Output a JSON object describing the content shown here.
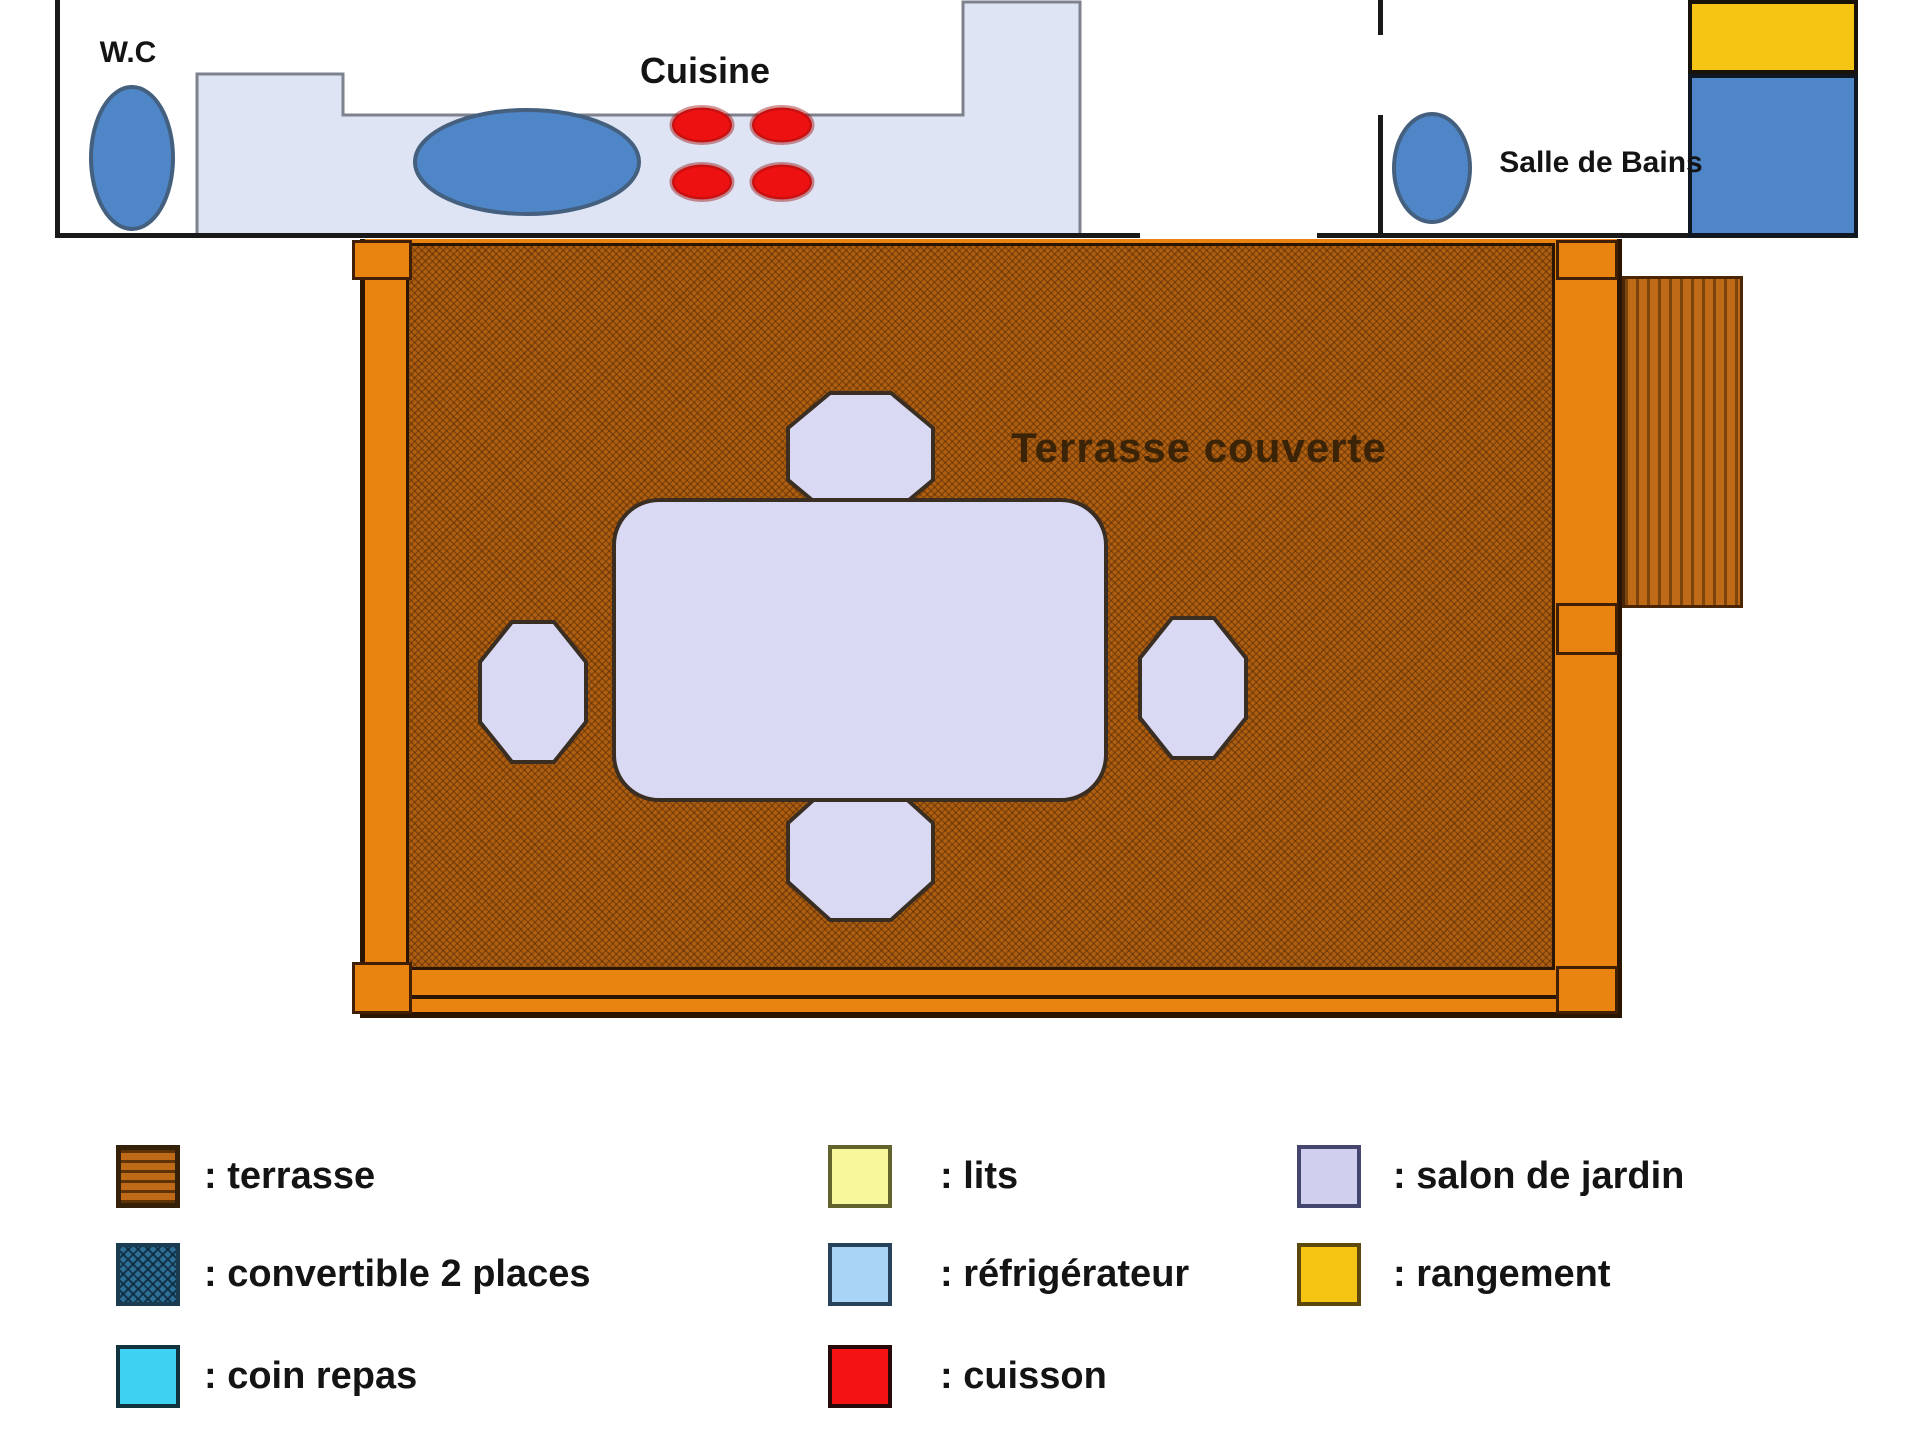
{
  "rooms": {
    "wc_label": "W.C",
    "cuisine_label": "Cuisine",
    "bathroom_label": "Salle de Bains",
    "terrace_label": "Terrasse couverte"
  },
  "colors": {
    "wall": "#191919",
    "floor": "#dee4f3",
    "floor_outline": "#7d828e",
    "fixture_blue": "#4e86c8",
    "fixture_outline": "#44607e",
    "burner_red": "#ee1111",
    "burner_outline": "#9c0f0f",
    "deck_rim_orange": "#ea8410",
    "deck_board_brown": "#b05f10",
    "deck_outline": "#2a1402",
    "steps_orange": "#bf6a16",
    "furniture_lavender": "#d9d9f4",
    "furniture_outline": "#3a2d22",
    "storage_yellow": "#f6c413",
    "bath_blue": "#4e86c8"
  },
  "legend": {
    "items": [
      {
        "id": "terrasse",
        "label": ": terrasse",
        "color": "#bf6a16",
        "border": "#35200a"
      },
      {
        "id": "convertible",
        "label": ": convertible 2 places",
        "color": "#2e6f96",
        "border": "#1b3b50"
      },
      {
        "id": "coin-repas",
        "label": ": coin repas",
        "color": "#3ed1f2",
        "border": "#10333d"
      },
      {
        "id": "lits",
        "label": ": lits",
        "color": "#f7f79c",
        "border": "#63632d"
      },
      {
        "id": "refrigerateur",
        "label": ": réfrigérateur",
        "color": "#a9d4f6",
        "border": "#27435c"
      },
      {
        "id": "cuisson",
        "label": ": cuisson",
        "color": "#f51212",
        "border": "#260909"
      },
      {
        "id": "salon-de-jardin",
        "label": ": salon de jardin",
        "color": "#d0d0ee",
        "border": "#45466e"
      },
      {
        "id": "rangement",
        "label": ": rangement",
        "color": "#f6c413",
        "border": "#5c470d"
      }
    ]
  }
}
